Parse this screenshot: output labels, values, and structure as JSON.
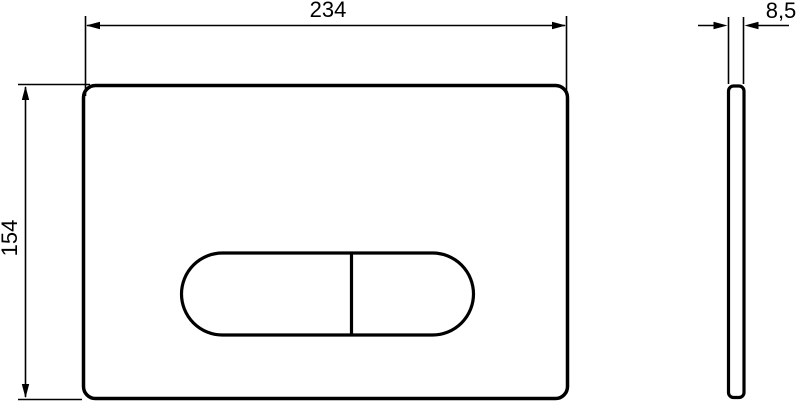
{
  "drawing": {
    "dimensions": {
      "width": "234",
      "height": "154",
      "thickness": "8,5"
    },
    "colors": {
      "line": "#000000",
      "background": "#ffffff"
    }
  }
}
